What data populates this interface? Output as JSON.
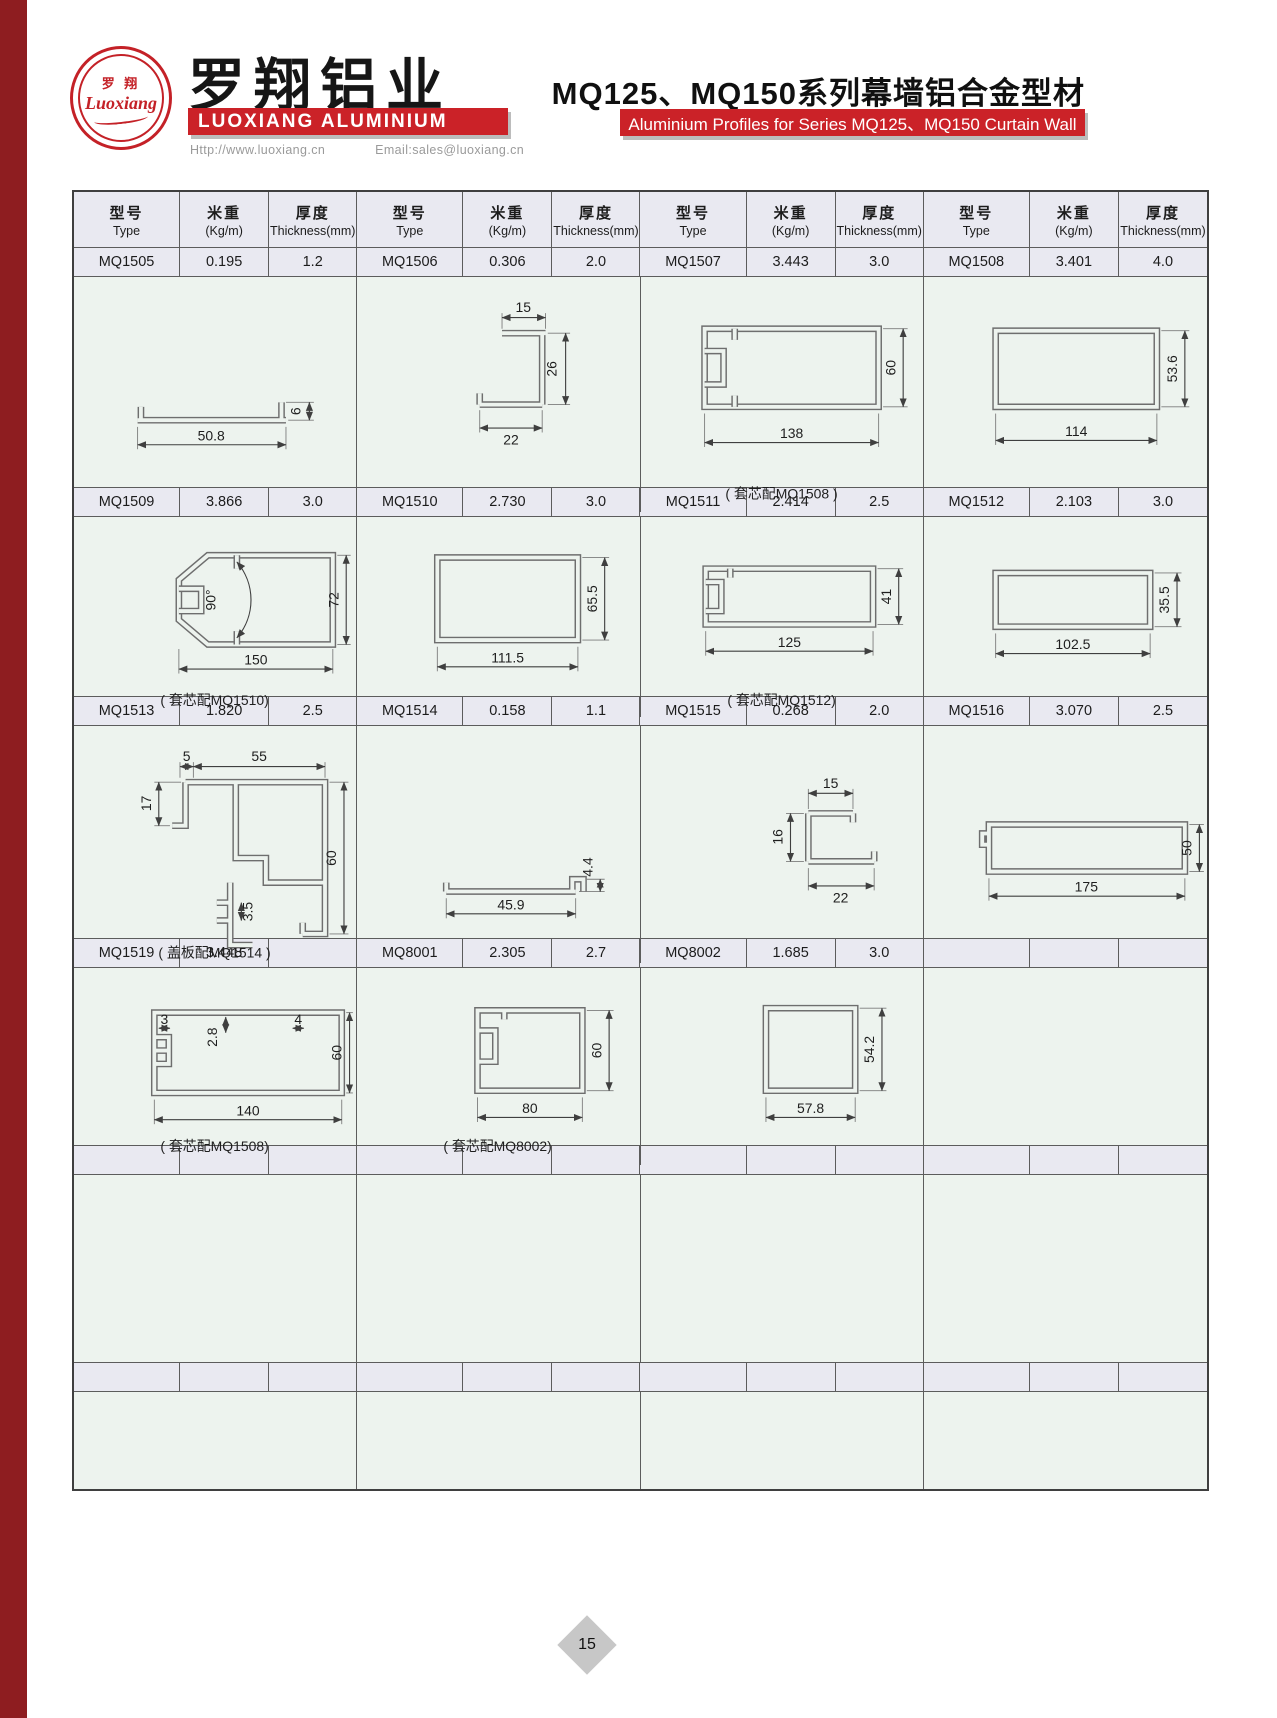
{
  "header": {
    "logo": {
      "cn": "罗 翔",
      "script": "Luoxiang"
    },
    "company_cn": "罗翔铝业",
    "company_en": "LUOXIANG ALUMINIUM",
    "website": "Http://www.luoxiang.cn",
    "email": "Email:sales@luoxiang.cn",
    "title_cn": "MQ125、MQ150系列幕墙铝合金型材",
    "title_en": "Aluminium Profiles for Series MQ125、MQ150 Curtain Wall"
  },
  "colors": {
    "accent_red": "#cb2228",
    "left_strip": "#8e1d20",
    "spec_row_bg": "#e9e9f1",
    "drawing_row_bg": "#edf3ee"
  },
  "table": {
    "headers": {
      "type_cn": "型号",
      "type_en": "Type",
      "weight_cn": "米重",
      "weight_en": "(Kg/m)",
      "thick_cn": "厚度",
      "thick_en": "Thickness(mm)"
    },
    "rows": [
      {
        "cells": [
          {
            "type": "MQ1505",
            "weight": "0.195",
            "thickness": "1.2"
          },
          {
            "type": "MQ1506",
            "weight": "0.306",
            "thickness": "2.0"
          },
          {
            "type": "MQ1507",
            "weight": "3.443",
            "thickness": "3.0"
          },
          {
            "type": "MQ1508",
            "weight": "3.401",
            "thickness": "4.0"
          }
        ],
        "drawings": [
          {
            "d1": "50.8",
            "d2": "6"
          },
          {
            "d1": "15",
            "d2": "26",
            "d3": "22"
          },
          {
            "d1": "138",
            "d2": "60",
            "caption": "( 套芯配MQ1508 )"
          },
          {
            "d1": "114",
            "d2": "53.6"
          }
        ]
      },
      {
        "cells": [
          {
            "type": "MQ1509",
            "weight": "3.866",
            "thickness": "3.0"
          },
          {
            "type": "MQ1510",
            "weight": "2.730",
            "thickness": "3.0"
          },
          {
            "type": "MQ1511",
            "weight": "2.414",
            "thickness": "2.5"
          },
          {
            "type": "MQ1512",
            "weight": "2.103",
            "thickness": "3.0"
          }
        ],
        "drawings": [
          {
            "d1": "150",
            "d2": "72",
            "d3": "90°",
            "caption": "( 套芯配MQ1510)"
          },
          {
            "d1": "111.5",
            "d2": "65.5"
          },
          {
            "d1": "125",
            "d2": "41",
            "caption": "( 套芯配MQ1512)"
          },
          {
            "d1": "102.5",
            "d2": "35.5"
          }
        ]
      },
      {
        "cells": [
          {
            "type": "MQ1513",
            "weight": "1.820",
            "thickness": "2.5"
          },
          {
            "type": "MQ1514",
            "weight": "0.158",
            "thickness": "1.1"
          },
          {
            "type": "MQ1515",
            "weight": "0.268",
            "thickness": "2.0"
          },
          {
            "type": "MQ1516",
            "weight": "3.070",
            "thickness": "2.5"
          }
        ],
        "drawings": [
          {
            "d1": "55",
            "d2": "5",
            "d3": "17",
            "d4": "60",
            "d5": "3.5",
            "caption": "( 盖板配MQ1514 )"
          },
          {
            "d1": "45.9",
            "d2": "4.4"
          },
          {
            "d1": "15",
            "d2": "16",
            "d3": "22"
          },
          {
            "d1": "175",
            "d2": "50"
          }
        ]
      },
      {
        "cells": [
          {
            "type": "MQ1519",
            "weight": "3.448",
            "thickness": ""
          },
          {
            "type": "MQ8001",
            "weight": "2.305",
            "thickness": "2.7"
          },
          {
            "type": "MQ8002",
            "weight": "1.685",
            "thickness": "3.0"
          },
          {
            "type": "",
            "weight": "",
            "thickness": ""
          }
        ],
        "drawings": [
          {
            "d1": "140",
            "d2": "60",
            "d3": "3",
            "d4": "2.8",
            "d5": "4",
            "caption": "( 套芯配MQ1508)"
          },
          {
            "d1": "80",
            "d2": "60",
            "caption": "( 套芯配MQ8002)"
          },
          {
            "d1": "57.8",
            "d2": "54.2"
          },
          {}
        ]
      },
      {
        "cells": [
          {
            "type": "",
            "weight": "",
            "thickness": ""
          },
          {
            "type": "",
            "weight": "",
            "thickness": ""
          },
          {
            "type": "",
            "weight": "",
            "thickness": ""
          },
          {
            "type": "",
            "weight": "",
            "thickness": ""
          }
        ],
        "drawings": [
          {},
          {},
          {},
          {}
        ]
      },
      {
        "cells": [
          {
            "type": "",
            "weight": "",
            "thickness": ""
          },
          {
            "type": "",
            "weight": "",
            "thickness": ""
          },
          {
            "type": "",
            "weight": "",
            "thickness": ""
          },
          {
            "type": "",
            "weight": "",
            "thickness": ""
          }
        ],
        "drawings": [
          {},
          {},
          {},
          {}
        ]
      }
    ]
  },
  "footer": {
    "page_number": "15"
  }
}
